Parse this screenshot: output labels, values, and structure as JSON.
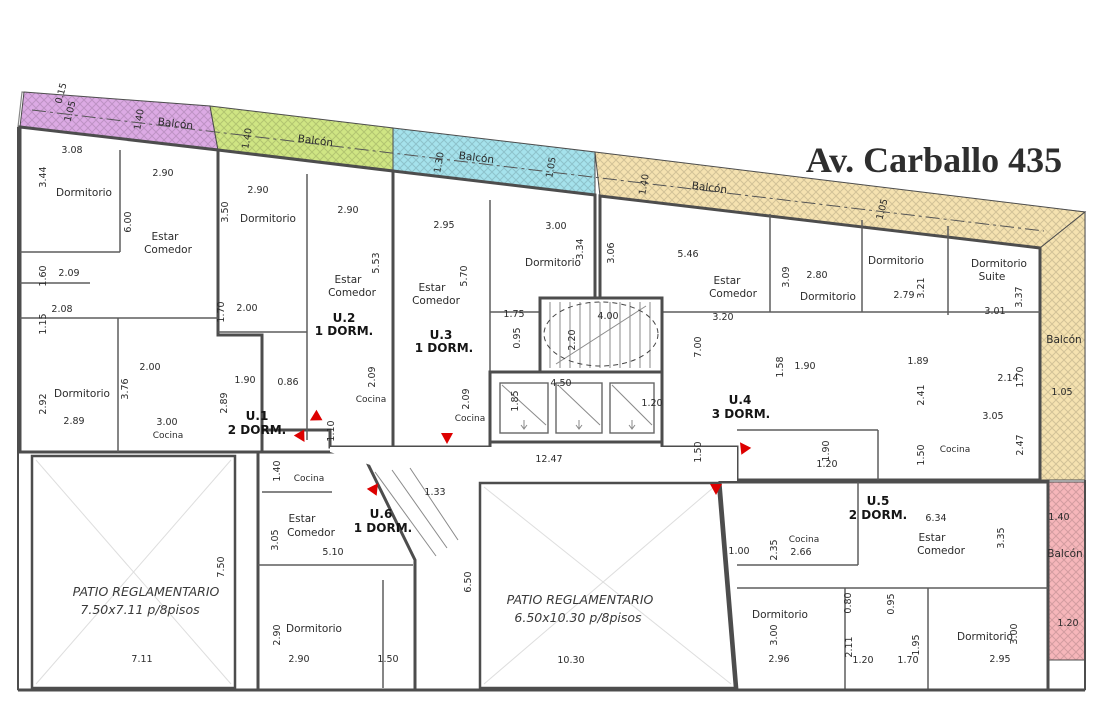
{
  "title": "Av. Carballo 435",
  "colors": {
    "wall": "#4d4d4d",
    "lot_line": "#888888",
    "arrow": "#dd0000",
    "title_text": "#2e2e2e",
    "patio_cross": "#dedede"
  },
  "units": [
    {
      "id": "u1",
      "label": "U.1",
      "type": "2 DORM.",
      "color": "#dcaae4"
    },
    {
      "id": "u2",
      "label": "U.2",
      "type": "1 DORM.",
      "color": "#cfe583"
    },
    {
      "id": "u3",
      "label": "U.3",
      "type": "1 DORM.",
      "color": "#a5e2ec"
    },
    {
      "id": "u4",
      "label": "U.4",
      "type": "3 DORM.",
      "color": "#f5e2b0"
    },
    {
      "id": "u5",
      "label": "U.5",
      "type": "2 DORM.",
      "color": "#f6b6ba"
    },
    {
      "id": "u6",
      "label": "U.6",
      "type": "1 DORM.",
      "color": "#fbc437"
    }
  ],
  "patios": [
    {
      "id": "patio-left",
      "line1": "PATIO REGLAMENTARIO",
      "line2": "7.50x7.11 p/8pisos"
    },
    {
      "id": "patio-center",
      "line1": "PATIO REGLAMENTARIO",
      "line2": "6.50x10.30 p/8pisos"
    }
  ],
  "arrows": [
    {
      "x": 316,
      "y": 417,
      "rot": -120
    },
    {
      "x": 301,
      "y": 436,
      "rot": 150
    },
    {
      "x": 374,
      "y": 489,
      "rot": 35
    },
    {
      "x": 447,
      "y": 437,
      "rot": 180
    },
    {
      "x": 744,
      "y": 448,
      "rot": -35
    },
    {
      "x": 716,
      "y": 488,
      "rot": 180
    }
  ],
  "annotations": [
    {
      "text": "Av. Carballo 435",
      "x": 934,
      "y": 172,
      "cls": "title"
    },
    {
      "text": "1.05",
      "x": 73,
      "y": 112,
      "rot": -75
    },
    {
      "text": "0.15",
      "x": 64,
      "y": 94,
      "rot": -75
    },
    {
      "text": "1.40",
      "x": 142,
      "y": 120,
      "rot": -80
    },
    {
      "text": "Balcón",
      "x": 175,
      "y": 127,
      "rot": 7,
      "cls": "room"
    },
    {
      "text": "3.08",
      "x": 72,
      "y": 153
    },
    {
      "text": "3.44",
      "x": 46,
      "y": 177,
      "rot": -90
    },
    {
      "text": "Dormitorio",
      "x": 84,
      "y": 196,
      "cls": "room"
    },
    {
      "text": "2.90",
      "x": 163,
      "y": 176
    },
    {
      "text": "6.00",
      "x": 131,
      "y": 222,
      "rot": -90
    },
    {
      "text": "Estar",
      "x": 165,
      "y": 240,
      "cls": "room"
    },
    {
      "text": "Comedor",
      "x": 168,
      "y": 253,
      "cls": "room"
    },
    {
      "text": "1.60",
      "x": 46,
      "y": 276,
      "rot": -90
    },
    {
      "text": "2.09",
      "x": 69,
      "y": 276
    },
    {
      "text": "2.08",
      "x": 62,
      "y": 312
    },
    {
      "text": "1.15",
      "x": 46,
      "y": 324,
      "rot": -90
    },
    {
      "text": "2.00",
      "x": 150,
      "y": 370
    },
    {
      "text": "3.76",
      "x": 128,
      "y": 389,
      "rot": -90
    },
    {
      "text": "2.92",
      "x": 46,
      "y": 404,
      "rot": -90
    },
    {
      "text": "Dormitorio",
      "x": 82,
      "y": 397,
      "cls": "room"
    },
    {
      "text": "2.89",
      "x": 74,
      "y": 424
    },
    {
      "text": "3.00",
      "x": 167,
      "y": 425
    },
    {
      "text": "Cocina",
      "x": 168,
      "y": 438,
      "cls": "rm2"
    },
    {
      "text": "1.90",
      "x": 245,
      "y": 383
    },
    {
      "text": "2.89",
      "x": 227,
      "y": 403,
      "rot": -90
    },
    {
      "text": "0.86",
      "x": 288,
      "y": 385
    },
    {
      "text": "U.1",
      "x": 257,
      "y": 420,
      "cls": "unit"
    },
    {
      "text": "2 DORM.",
      "x": 257,
      "y": 434,
      "cls": "unit"
    },
    {
      "text": "1.40",
      "x": 250,
      "y": 139,
      "rot": -80
    },
    {
      "text": "Balcón",
      "x": 315,
      "y": 144,
      "rot": 7,
      "cls": "room"
    },
    {
      "text": "2.90",
      "x": 258,
      "y": 193
    },
    {
      "text": "3.50",
      "x": 228,
      "y": 212,
      "rot": -90
    },
    {
      "text": "Dormitorio",
      "x": 268,
      "y": 222,
      "cls": "room"
    },
    {
      "text": "2.90",
      "x": 348,
      "y": 213
    },
    {
      "text": "5.53",
      "x": 379,
      "y": 263,
      "rot": -90
    },
    {
      "text": "Estar",
      "x": 348,
      "y": 283,
      "cls": "room"
    },
    {
      "text": "Comedor",
      "x": 352,
      "y": 296,
      "cls": "room"
    },
    {
      "text": "1.70",
      "x": 224,
      "y": 312,
      "rot": -90
    },
    {
      "text": "2.00",
      "x": 247,
      "y": 311
    },
    {
      "text": "U.2",
      "x": 344,
      "y": 322,
      "cls": "unit"
    },
    {
      "text": "1 DORM.",
      "x": 344,
      "y": 335,
      "cls": "unit"
    },
    {
      "text": "2.09",
      "x": 375,
      "y": 377,
      "rot": -90
    },
    {
      "text": "Cocina",
      "x": 371,
      "y": 402,
      "cls": "rm2"
    },
    {
      "text": "1.10",
      "x": 334,
      "y": 431,
      "rot": -90
    },
    {
      "text": "1.30",
      "x": 442,
      "y": 163,
      "rot": -80
    },
    {
      "text": "Balcón",
      "x": 476,
      "y": 161,
      "rot": 7,
      "cls": "room"
    },
    {
      "text": "1.05",
      "x": 554,
      "y": 168,
      "rot": -80
    },
    {
      "text": "2.95",
      "x": 444,
      "y": 228
    },
    {
      "text": "3.00",
      "x": 556,
      "y": 229
    },
    {
      "text": "3.34",
      "x": 583,
      "y": 249,
      "rot": -90
    },
    {
      "text": "Dormitorio",
      "x": 553,
      "y": 266,
      "cls": "room"
    },
    {
      "text": "5.70",
      "x": 467,
      "y": 276,
      "rot": -90
    },
    {
      "text": "Estar",
      "x": 432,
      "y": 291,
      "cls": "room"
    },
    {
      "text": "Comedor",
      "x": 436,
      "y": 304,
      "cls": "room"
    },
    {
      "text": "U.3",
      "x": 441,
      "y": 339,
      "cls": "unit"
    },
    {
      "text": "1 DORM.",
      "x": 444,
      "y": 352,
      "cls": "unit"
    },
    {
      "text": "1.75",
      "x": 514,
      "y": 317
    },
    {
      "text": "0.95",
      "x": 520,
      "y": 338,
      "rot": -90
    },
    {
      "text": "2.09",
      "x": 469,
      "y": 399,
      "rot": -90
    },
    {
      "text": "Cocina",
      "x": 470,
      "y": 421,
      "cls": "rm2"
    },
    {
      "text": "4.00",
      "x": 608,
      "y": 319
    },
    {
      "text": "2.20",
      "x": 575,
      "y": 340,
      "rot": -90
    },
    {
      "text": "4.50",
      "x": 561,
      "y": 386
    },
    {
      "text": "1.85",
      "x": 518,
      "y": 401,
      "rot": -90
    },
    {
      "text": "1.20",
      "x": 652,
      "y": 406
    },
    {
      "text": "12.47",
      "x": 549,
      "y": 462
    },
    {
      "text": "1.50",
      "x": 701,
      "y": 452,
      "rot": -90
    },
    {
      "text": "1.40",
      "x": 647,
      "y": 185,
      "rot": -80
    },
    {
      "text": "Balcón",
      "x": 709,
      "y": 191,
      "rot": 7,
      "cls": "room"
    },
    {
      "text": "1.05",
      "x": 885,
      "y": 210,
      "rot": -75
    },
    {
      "text": "3.06",
      "x": 614,
      "y": 253,
      "rot": -90
    },
    {
      "text": "5.46",
      "x": 688,
      "y": 257
    },
    {
      "text": "Estar",
      "x": 727,
      "y": 284,
      "cls": "room"
    },
    {
      "text": "Comedor",
      "x": 733,
      "y": 297,
      "cls": "room"
    },
    {
      "text": "3.20",
      "x": 723,
      "y": 320
    },
    {
      "text": "7.00",
      "x": 701,
      "y": 347,
      "rot": -90
    },
    {
      "text": "3.09",
      "x": 789,
      "y": 277,
      "rot": -90
    },
    {
      "text": "2.80",
      "x": 817,
      "y": 278
    },
    {
      "text": "Dormitorio",
      "x": 828,
      "y": 300,
      "cls": "room"
    },
    {
      "text": "Dormitorio",
      "x": 896,
      "y": 264,
      "cls": "room"
    },
    {
      "text": "3.21",
      "x": 924,
      "y": 288,
      "rot": -90
    },
    {
      "text": "2.79",
      "x": 904,
      "y": 298
    },
    {
      "text": "Dormitorio",
      "x": 999,
      "y": 267,
      "cls": "room"
    },
    {
      "text": "Suite",
      "x": 992,
      "y": 280,
      "cls": "room"
    },
    {
      "text": "3.37",
      "x": 1022,
      "y": 297,
      "rot": -90
    },
    {
      "text": "3.01",
      "x": 995,
      "y": 314
    },
    {
      "text": "Balcón",
      "x": 1064,
      "y": 343,
      "cls": "room"
    },
    {
      "text": "1.58",
      "x": 783,
      "y": 367,
      "rot": -90
    },
    {
      "text": "1.90",
      "x": 805,
      "y": 369
    },
    {
      "text": "1.89",
      "x": 918,
      "y": 364
    },
    {
      "text": "2.14",
      "x": 1008,
      "y": 381
    },
    {
      "text": "1.70",
      "x": 1023,
      "y": 377,
      "rot": -90
    },
    {
      "text": "2.41",
      "x": 924,
      "y": 395,
      "rot": -90
    },
    {
      "text": "1.05",
      "x": 1062,
      "y": 395
    },
    {
      "text": "U.4",
      "x": 740,
      "y": 404,
      "cls": "unit"
    },
    {
      "text": "3 DORM.",
      "x": 741,
      "y": 418,
      "cls": "unit"
    },
    {
      "text": "1.90",
      "x": 829,
      "y": 451,
      "rot": -90
    },
    {
      "text": "1.20",
      "x": 827,
      "y": 467
    },
    {
      "text": "3.05",
      "x": 993,
      "y": 419
    },
    {
      "text": "1.50",
      "x": 924,
      "y": 455,
      "rot": -90
    },
    {
      "text": "Cocina",
      "x": 955,
      "y": 452,
      "cls": "rm2"
    },
    {
      "text": "2.47",
      "x": 1023,
      "y": 445,
      "rot": -90
    },
    {
      "text": "U.5",
      "x": 878,
      "y": 505,
      "cls": "unit"
    },
    {
      "text": "2 DORM.",
      "x": 878,
      "y": 519,
      "cls": "unit"
    },
    {
      "text": "6.34",
      "x": 936,
      "y": 521
    },
    {
      "text": "1.40",
      "x": 1059,
      "y": 520
    },
    {
      "text": "Estar",
      "x": 932,
      "y": 541,
      "cls": "room"
    },
    {
      "text": "Comedor",
      "x": 941,
      "y": 554,
      "cls": "room"
    },
    {
      "text": "3.35",
      "x": 1004,
      "y": 538,
      "rot": -90
    },
    {
      "text": "Balcón",
      "x": 1065,
      "y": 557,
      "cls": "room"
    },
    {
      "text": "1.00",
      "x": 739,
      "y": 554
    },
    {
      "text": "2.35",
      "x": 777,
      "y": 550,
      "rot": -90
    },
    {
      "text": "Cocina",
      "x": 804,
      "y": 542,
      "cls": "rm2"
    },
    {
      "text": "2.66",
      "x": 801,
      "y": 555
    },
    {
      "text": "Dormitorio",
      "x": 780,
      "y": 618,
      "cls": "room"
    },
    {
      "text": "3.00",
      "x": 777,
      "y": 635,
      "rot": -90
    },
    {
      "text": "2.96",
      "x": 779,
      "y": 662
    },
    {
      "text": "0.80",
      "x": 851,
      "y": 603,
      "rot": -90
    },
    {
      "text": "0.95",
      "x": 894,
      "y": 604,
      "rot": -90
    },
    {
      "text": "2.11",
      "x": 852,
      "y": 647,
      "rot": -90
    },
    {
      "text": "1.20",
      "x": 863,
      "y": 663
    },
    {
      "text": "1.70",
      "x": 908,
      "y": 663
    },
    {
      "text": "1.95",
      "x": 919,
      "y": 645,
      "rot": -90
    },
    {
      "text": "Dormitorio",
      "x": 985,
      "y": 640,
      "cls": "room"
    },
    {
      "text": "3.00",
      "x": 1017,
      "y": 634,
      "rot": -90
    },
    {
      "text": "2.95",
      "x": 1000,
      "y": 662
    },
    {
      "text": "1.20",
      "x": 1068,
      "y": 626
    },
    {
      "text": "1.40",
      "x": 280,
      "y": 471,
      "rot": -90
    },
    {
      "text": "Cocina",
      "x": 309,
      "y": 481,
      "cls": "rm2"
    },
    {
      "text": "Estar",
      "x": 302,
      "y": 522,
      "cls": "room"
    },
    {
      "text": "Comedor",
      "x": 311,
      "y": 536,
      "cls": "room"
    },
    {
      "text": "3.05",
      "x": 278,
      "y": 540,
      "rot": -90
    },
    {
      "text": "5.10",
      "x": 333,
      "y": 555
    },
    {
      "text": "U.6",
      "x": 381,
      "y": 518,
      "cls": "unit"
    },
    {
      "text": "1 DORM.",
      "x": 383,
      "y": 532,
      "cls": "unit"
    },
    {
      "text": "1.33",
      "x": 435,
      "y": 495
    },
    {
      "text": "Dormitorio",
      "x": 314,
      "y": 632,
      "cls": "room"
    },
    {
      "text": "2.90",
      "x": 280,
      "y": 635,
      "rot": -90
    },
    {
      "text": "2.90",
      "x": 299,
      "y": 662
    },
    {
      "text": "1.50",
      "x": 388,
      "y": 662
    },
    {
      "text": "PATIO REGLAMENTARIO",
      "x": 146,
      "y": 596,
      "cls": "patio"
    },
    {
      "text": "7.50x7.11 p/8pisos",
      "x": 140,
      "y": 614,
      "cls": "patio"
    },
    {
      "text": "7.50",
      "x": 224,
      "y": 567,
      "rot": -90
    },
    {
      "text": "7.11",
      "x": 142,
      "y": 662
    },
    {
      "text": "PATIO REGLAMENTARIO",
      "x": 580,
      "y": 604,
      "cls": "patio"
    },
    {
      "text": "6.50x10.30 p/8pisos",
      "x": 578,
      "y": 622,
      "cls": "patio"
    },
    {
      "text": "6.50",
      "x": 471,
      "y": 582,
      "rot": -90
    },
    {
      "text": "10.30",
      "x": 571,
      "y": 663
    }
  ]
}
